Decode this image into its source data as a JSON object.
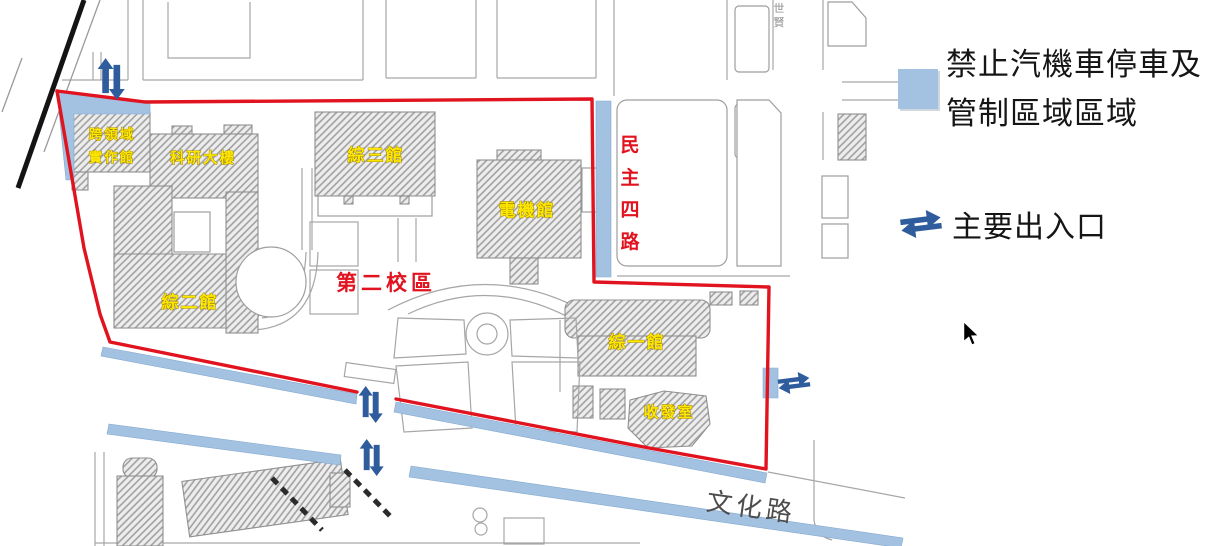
{
  "legend": {
    "no_parking_line1": "禁止汽機車停車及",
    "no_parking_line2": "管制區域區域",
    "entrance_label": "主要出入口"
  },
  "map": {
    "campus_area_label": "第二校區",
    "buildings": {
      "interdisciplinary_line1": "跨領域",
      "interdisciplinary_line2": "實作館",
      "research_building": "科研大樓",
      "zong_3_hall": "綜三館",
      "electrical_hall": "電機館",
      "zong_2_hall": "綜二館",
      "zong_1_hall": "綜一館",
      "mail_room": "收發室"
    },
    "roads": {
      "minzhu_4th_chars": [
        "民",
        "主",
        "四",
        "路"
      ],
      "wenhua_road": "文化路",
      "edge_road_label": "世賢"
    },
    "colors": {
      "boundary_red": "#e0131f",
      "restricted_blue": "#a3c2e2",
      "arrow_blue": "#2e5c9c",
      "building_label_yellow": "#ffe800"
    }
  }
}
